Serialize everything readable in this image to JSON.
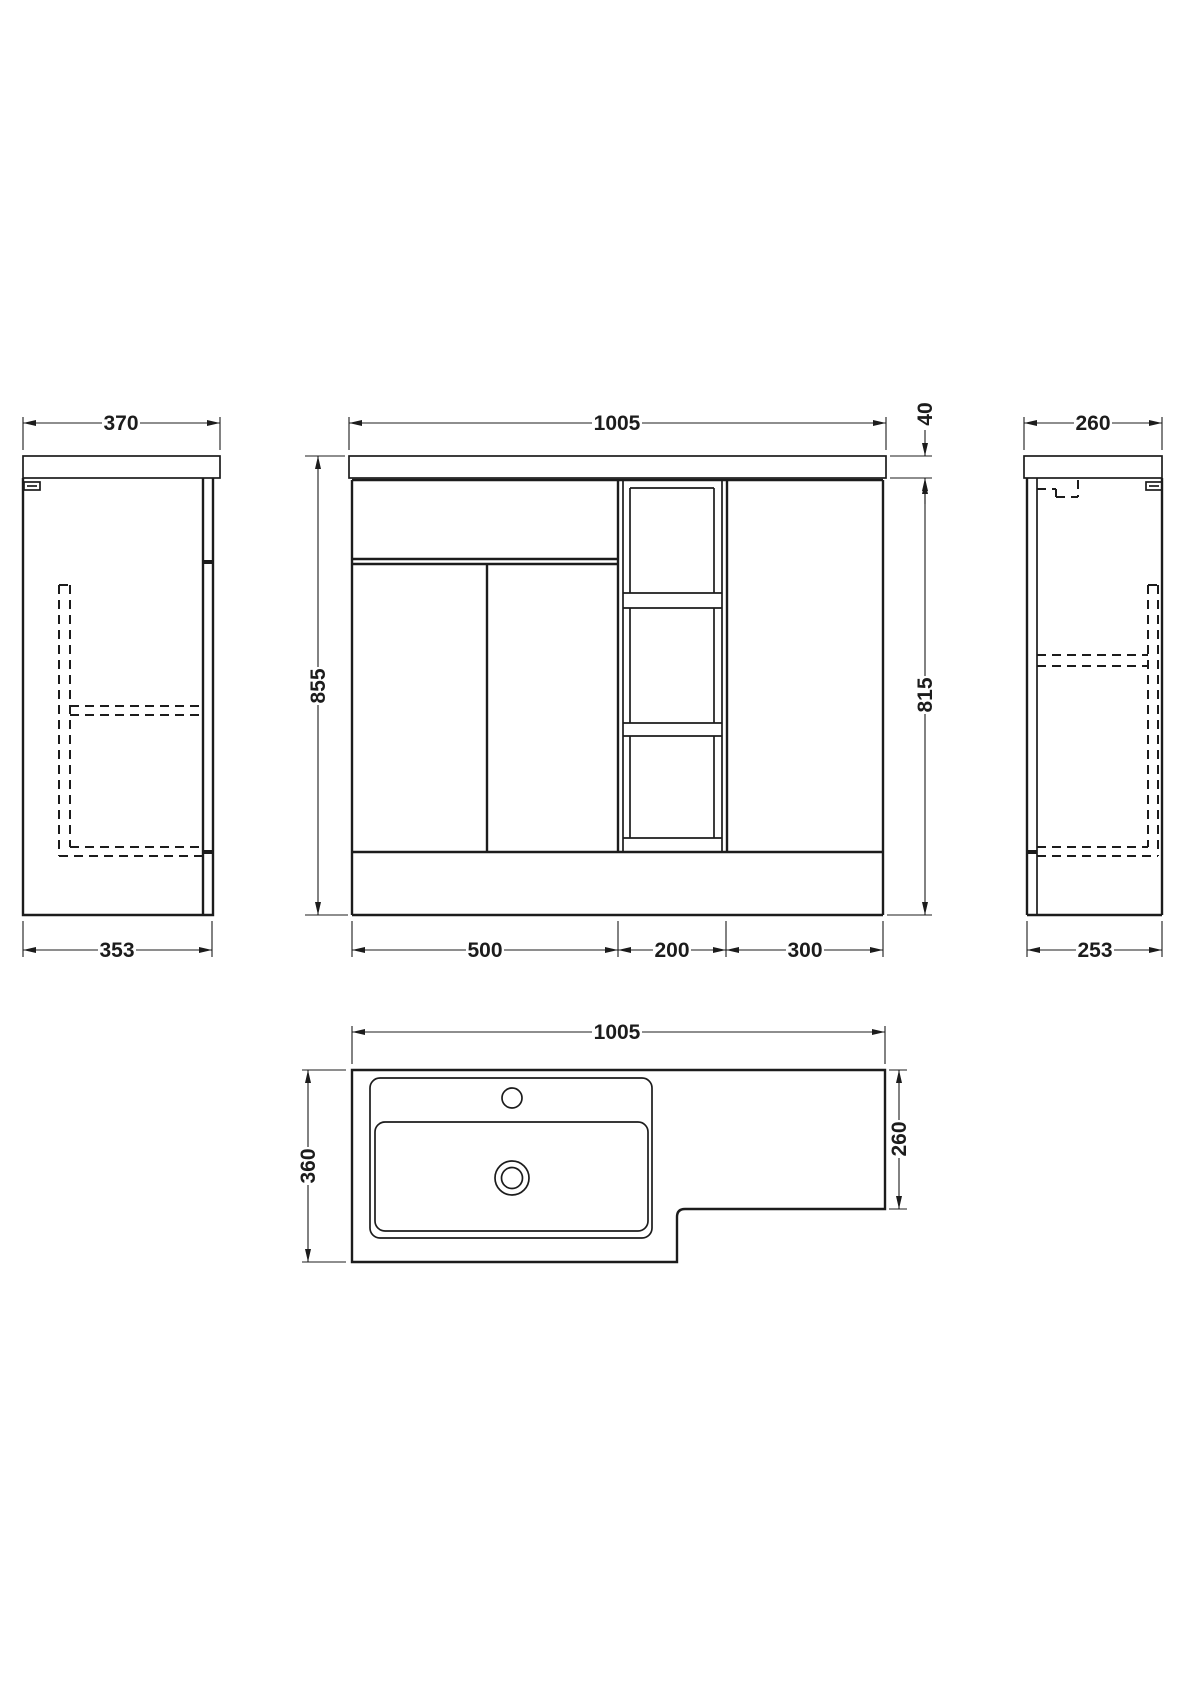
{
  "drawing": {
    "background": "#ffffff",
    "line_color": "#1c1c1c",
    "views": {
      "side_left": {
        "name": "left-side-elevation",
        "dims": {
          "counter_depth": "370",
          "cabinet_depth": "353"
        }
      },
      "front": {
        "name": "front-elevation",
        "dims": {
          "overall_width": "1005",
          "counter_thickness": "40",
          "overall_height": "855",
          "cabinet_height": "815",
          "vanity_section_width": "500",
          "shelf_section_width": "200",
          "wc_section_width": "300"
        }
      },
      "side_right": {
        "name": "right-side-elevation",
        "dims": {
          "counter_depth": "260",
          "cabinet_depth": "253"
        }
      },
      "plan": {
        "name": "plan-view",
        "dims": {
          "overall_width": "1005",
          "basin_depth": "360",
          "wc_depth": "260"
        }
      }
    }
  }
}
